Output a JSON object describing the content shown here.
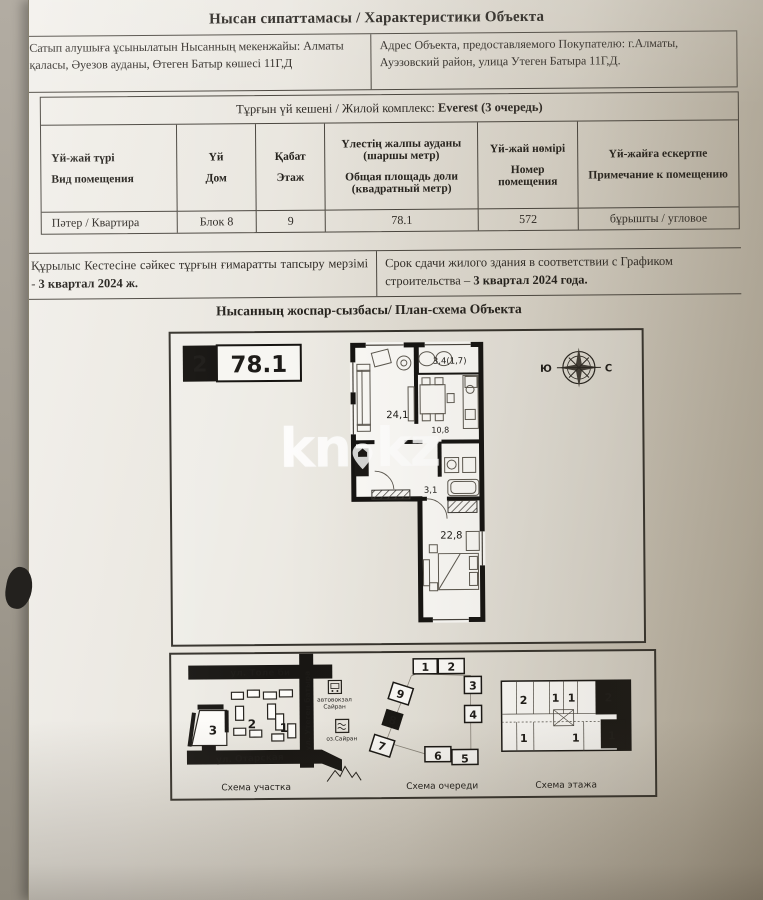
{
  "document": {
    "title": "Нысан сипаттамасы / Характеристики Объекта",
    "address": {
      "kz": "Сатып алушыға ұсынылатын Нысанның мекенжайы: Алматы қаласы, Әуезов ауданы, Өтеген Батыр көшесі 11Г,Д",
      "ru": "Адрес Объекта, предоставляемого Покупателю: г.Алматы, Ауэзовский район, улица Утеген Батыра 11Г,Д."
    },
    "complex_row": {
      "label": "Тұрғын үй кешені / Жилой комплекс:",
      "value": "Everest (3 очередь)"
    },
    "columns": [
      {
        "kz": "Үй-жай түрі",
        "ru": "Вид помещения"
      },
      {
        "kz": "Үй",
        "ru": "Дом"
      },
      {
        "kz": "Қабат",
        "ru": "Этаж"
      },
      {
        "kz": "Үлестің жалпы ауданы (шаршы метр)",
        "ru": "Общая площадь доли (квадратный метр)"
      },
      {
        "kz": "Үй-жай нөмірі",
        "ru": "Номер помещения"
      },
      {
        "kz": "Үй-жайға ескертпе",
        "ru": "Примечание к помещению"
      }
    ],
    "row": {
      "type": "Пәтер / Квартира",
      "house": "Блок 8",
      "floor": "9",
      "area": "78.1",
      "number": "572",
      "note": "бұрышты / угловое"
    },
    "deadline": {
      "kz": "Құрылыс Кестесіне сәйкес тұрғын ғимаратты тапсыру мерзімі - ",
      "kz_bold": "3 квартал 2024 ж.",
      "ru": "Срок сдачи жилого здания в соответствии с Графиком строительства – ",
      "ru_bold": "3 квартал 2024 года."
    },
    "plan_title": "Нысанның жоспар-сызбасы/ План-схема Объекта"
  },
  "plan": {
    "legend": {
      "rooms": "2",
      "area": "78.1"
    },
    "labels": {
      "living": "24,1",
      "balcony": "3,4(1,7)",
      "kitchen": "10,8",
      "hall": "3,1",
      "bedroom": "22,8"
    },
    "compass": {
      "west_label": "Ю",
      "east_label": "С"
    },
    "watermark": {
      "prefix": "kn",
      "suffix": "kz"
    }
  },
  "schemas": {
    "site": {
      "caption": "Схема участка",
      "street_top": "ул. Толе би",
      "street_vertical": "ул. Утеген батыра",
      "street_bottom": "ул. Отарская",
      "zones": [
        "3",
        "2",
        "1"
      ],
      "landmark_bus_line1": "автовокзал",
      "landmark_bus_line2": "Сайран",
      "landmark_lake": "оз.Сайран"
    },
    "queue": {
      "caption": "Схема очереди",
      "blocks": [
        "1",
        "2",
        "3",
        "4",
        "5",
        "6",
        "7",
        "8",
        "9"
      ]
    },
    "floor": {
      "caption": "Схема этажа",
      "units": [
        "2",
        "1",
        "1",
        "2",
        "1",
        "1",
        "1"
      ]
    }
  }
}
